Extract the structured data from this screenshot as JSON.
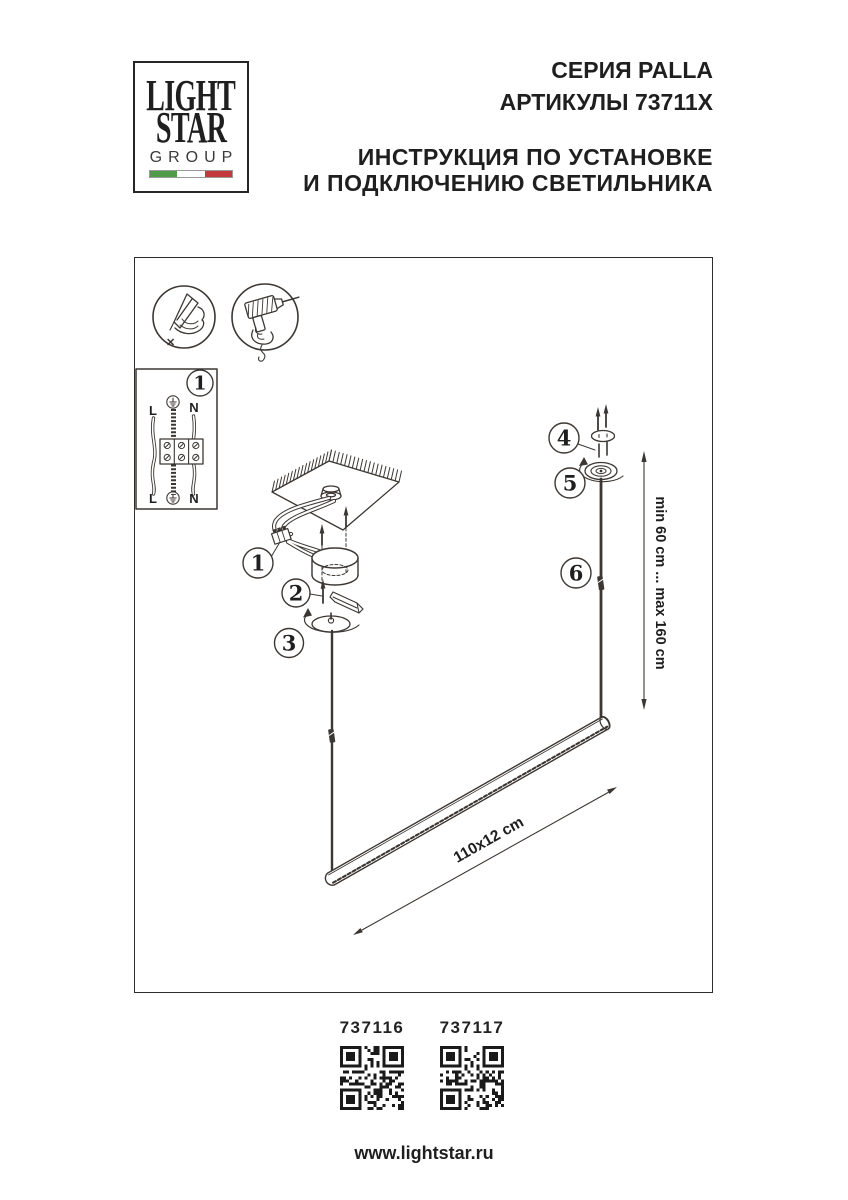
{
  "header": {
    "logo": {
      "line1": "LIGHT",
      "line2": "STAR",
      "line3": "GROUP"
    },
    "series": "СЕРИЯ PALLA",
    "articles": "АРТИКУЛЫ 73711X",
    "instruction_line1": "ИНСТРУКЦИЯ ПО УСТАНОВКЕ",
    "instruction_line2": "И ПОДКЛЮЧЕНИЮ СВЕТИЛЬНИКА"
  },
  "diagram": {
    "wiring": {
      "step_label": "1",
      "top_left": "L",
      "top_right": "N",
      "bottom_left": "L",
      "bottom_right": "N"
    },
    "steps": {
      "step1": "1",
      "step2": "2",
      "step3": "3",
      "step4": "4",
      "step5": "5",
      "step6": "6"
    },
    "dimensions": {
      "suspension": "min 60 cm ... max 160 cm",
      "fixture_size": "110x12 cm"
    }
  },
  "footer": {
    "qr_codes": [
      {
        "label": "737116"
      },
      {
        "label": "737117"
      }
    ],
    "website": "www.lightstar.ru"
  },
  "colors": {
    "line": "#3c3733",
    "text": "#1f1f1f",
    "flag_green": "#4f9b47",
    "flag_red": "#c23a3e"
  }
}
